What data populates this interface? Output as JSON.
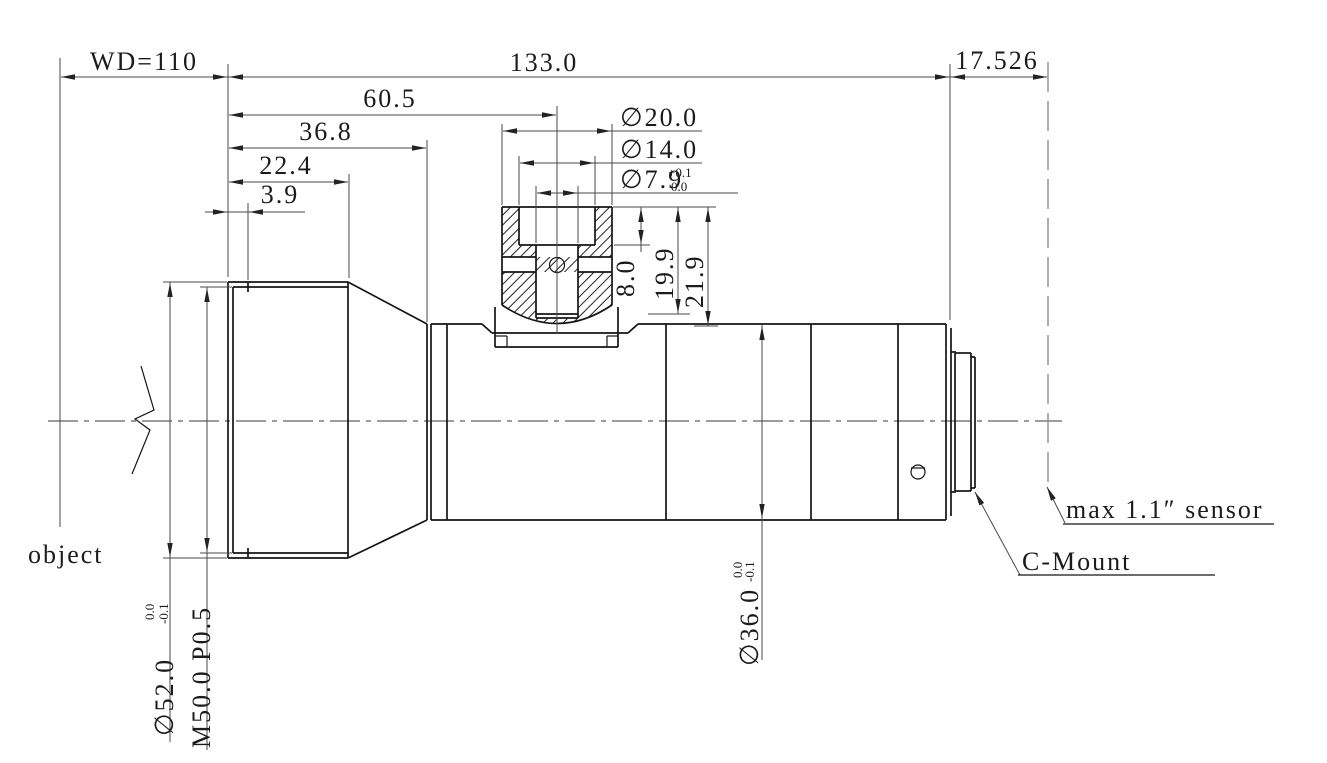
{
  "dims": {
    "wd": "WD=110",
    "length": "133.0",
    "flange": "17.526",
    "d60": "60.5",
    "d36": "36.8",
    "d22": "22.4",
    "d3": "3.9",
    "port_d20": "∅20.0",
    "port_d14": "∅14.0",
    "port_d79": "∅7.9",
    "port_d79_tol_up": "+0.1",
    "port_d79_tol_dn": "0.0",
    "h8": "8.0",
    "h19": "19.9",
    "h21": "21.9",
    "front_dia": "∅52.0",
    "front_dia_tol_up": "0.0",
    "front_dia_tol_dn": "-0.1",
    "front_thread": "M50.0 P0.5",
    "body_dia": "∅36.0",
    "body_dia_tol_up": "0.0",
    "body_dia_tol_dn": "-0.1"
  },
  "ann": {
    "object": "object",
    "sensor": "max 1.1″ sensor",
    "mount": "C-Mount"
  },
  "colors": {
    "line": "#141414",
    "dimension": "#4a4a4a",
    "background": "#ffffff"
  }
}
